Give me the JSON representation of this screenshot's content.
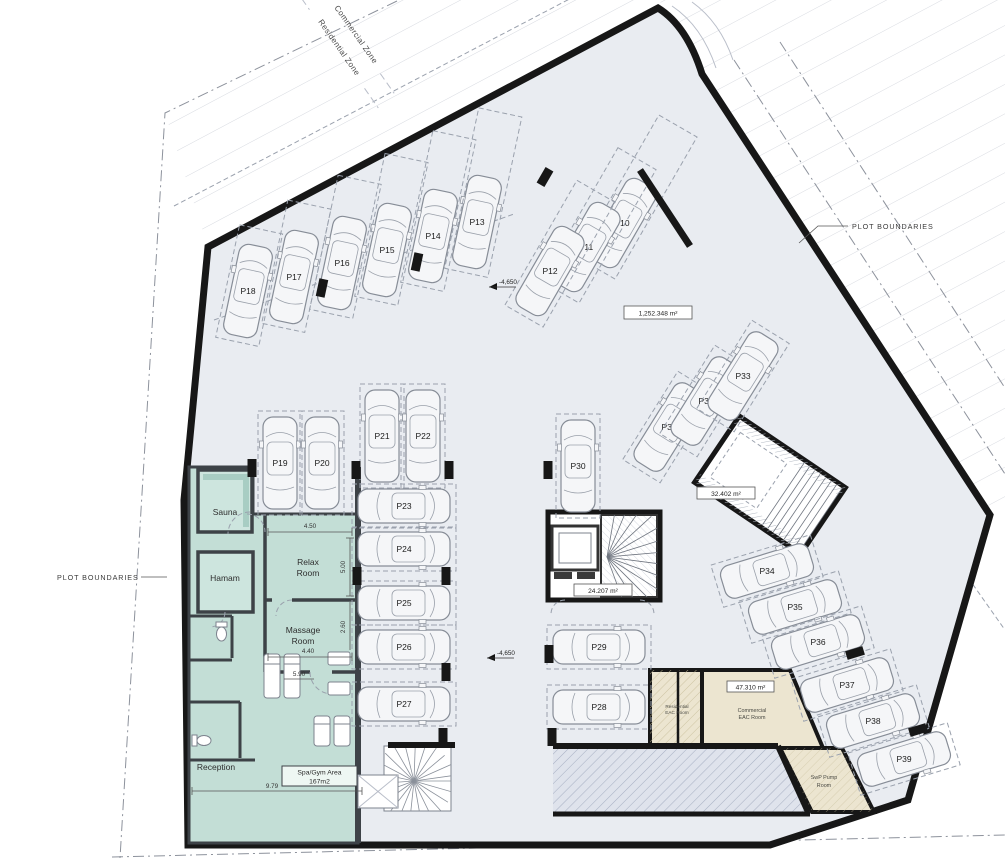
{
  "zones": {
    "commercial": "Commercial Zone",
    "residential": "Residential Zone"
  },
  "plot": {
    "boundary_label_left": "PLOT BOUNDARIES",
    "boundary_label_right": "PLOT BOUNDARIES",
    "total_area": "1,252.348 m²"
  },
  "levels": {
    "upper": "-4,650",
    "lower": "-4,650"
  },
  "cores": {
    "stair_right_area": "32.402 m²",
    "stair_center_area": "24.207 m²"
  },
  "rooms": {
    "sauna": "Sauna",
    "hamam": "Hamam",
    "relax": [
      "Relax",
      "Room"
    ],
    "massage": [
      "Massage",
      "Room"
    ],
    "reception": "Reception",
    "spa_gym": [
      "Spa/Gym Area",
      "167m2"
    ],
    "residential_eac": [
      "Residential",
      "EAC Room"
    ],
    "commercial_eac": [
      "Commercial",
      "EAC Room"
    ],
    "commercial_eac_area": "47.310 m²",
    "swp_pump": [
      "SwP Pump",
      "Room"
    ]
  },
  "dimensions": {
    "relax_w": "4.50",
    "relax_h": "5.00",
    "massage_w": "4.40",
    "massage_h": "2.60",
    "spa_mid": "5.90",
    "spa_w": "9.79"
  },
  "parking": {
    "spots": [
      "P10",
      "P11",
      "P12",
      "P13",
      "P14",
      "P15",
      "P16",
      "P17",
      "P18",
      "P19",
      "P20",
      "P21",
      "P22",
      "P23",
      "P24",
      "P25",
      "P26",
      "P27",
      "P28",
      "P29",
      "P30",
      "P31",
      "P32",
      "P33",
      "P34",
      "P35",
      "P36",
      "P37",
      "P38",
      "P39"
    ]
  },
  "colors": {
    "floor": "#e9ecf1",
    "spa": "#c3ded6",
    "service": "#ece5d0",
    "wall": "#171717"
  }
}
